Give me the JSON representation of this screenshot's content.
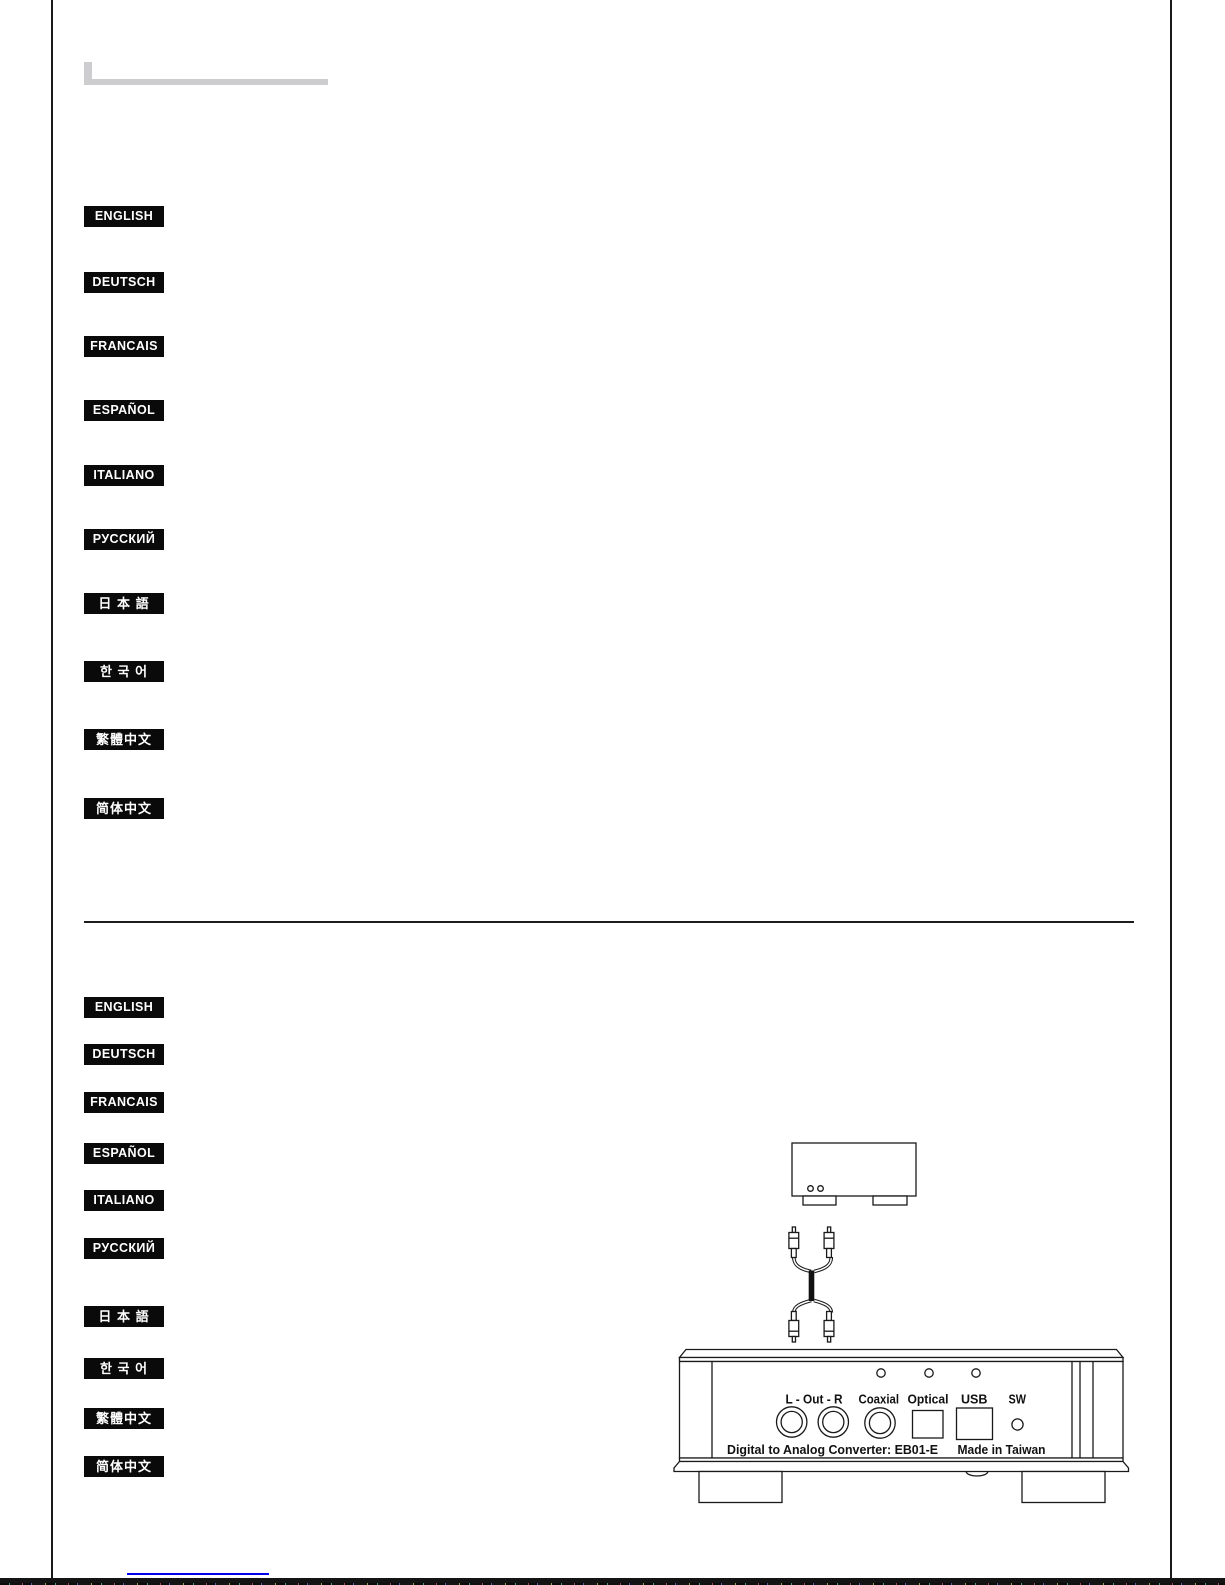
{
  "languages_top": [
    "ENGLISH",
    "DEUTSCH",
    "FRANCAIS",
    "ESPAÑOL",
    "ITALIANO",
    "РУССКИЙ",
    "日 本 語",
    "한 국 어",
    "繁體中文",
    "简体中文"
  ],
  "languages_bottom": [
    "ENGLISH",
    "DEUTSCH",
    "FRANCAIS",
    "ESPAÑOL",
    "ITALIANO",
    "РУССКИЙ",
    "日 本 語",
    "한 국 어",
    "繁體中文",
    "简体中文"
  ],
  "device_panel": {
    "output_label": "L - Out - R",
    "coaxial_label": "Coaxial",
    "optical_label": "Optical",
    "usb_label": "USB",
    "switch_label": "SW",
    "model_text": "Digital to Analog Converter: EB01-E",
    "origin_text": "Made in Taiwan"
  },
  "colors": {
    "badge_background": "#0a0a0a",
    "badge_text": "#ffffff",
    "ink": "#1a1a1a",
    "link_blue": "#0000ee",
    "title_placeholder_gray": "#cdcdd0"
  }
}
